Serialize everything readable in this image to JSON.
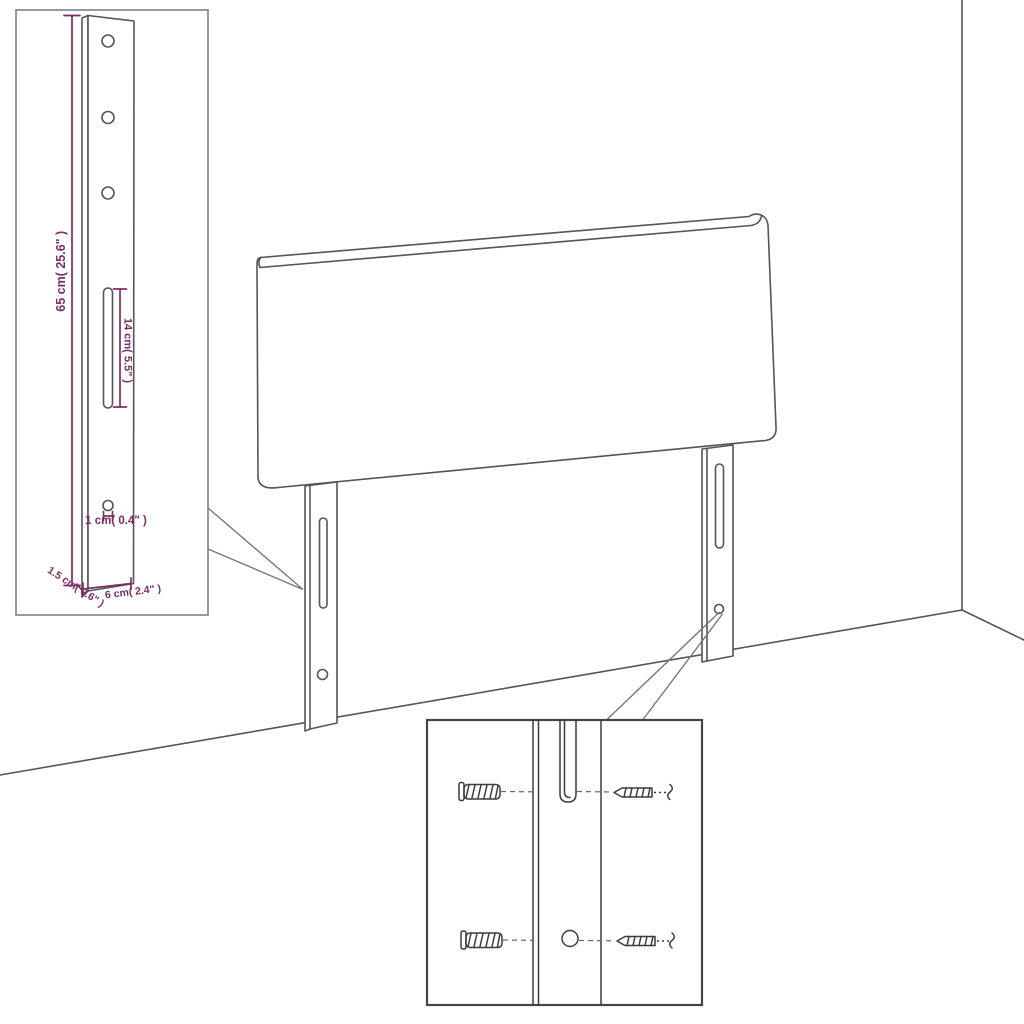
{
  "diagram": {
    "subject": "headboard-with-mounting-legs-assembly-diagram",
    "accent_color": "#7b2e62",
    "line_color": "#555555",
    "leg_detail_inset": {
      "dimensions": {
        "height": "65 cm( 25.6\" )",
        "slot_length": "14 cm( 5.5\" )",
        "hole_diameter": "1 cm( 0.4\" )",
        "thickness": "1.5 cm( 0.6\" )",
        "width": "6 cm( 2.4\" )"
      }
    },
    "mounting_detail_inset": {
      "icons": [
        {
          "icon": "wall-plug-icon"
        },
        {
          "icon": "screw-icon"
        }
      ]
    }
  }
}
